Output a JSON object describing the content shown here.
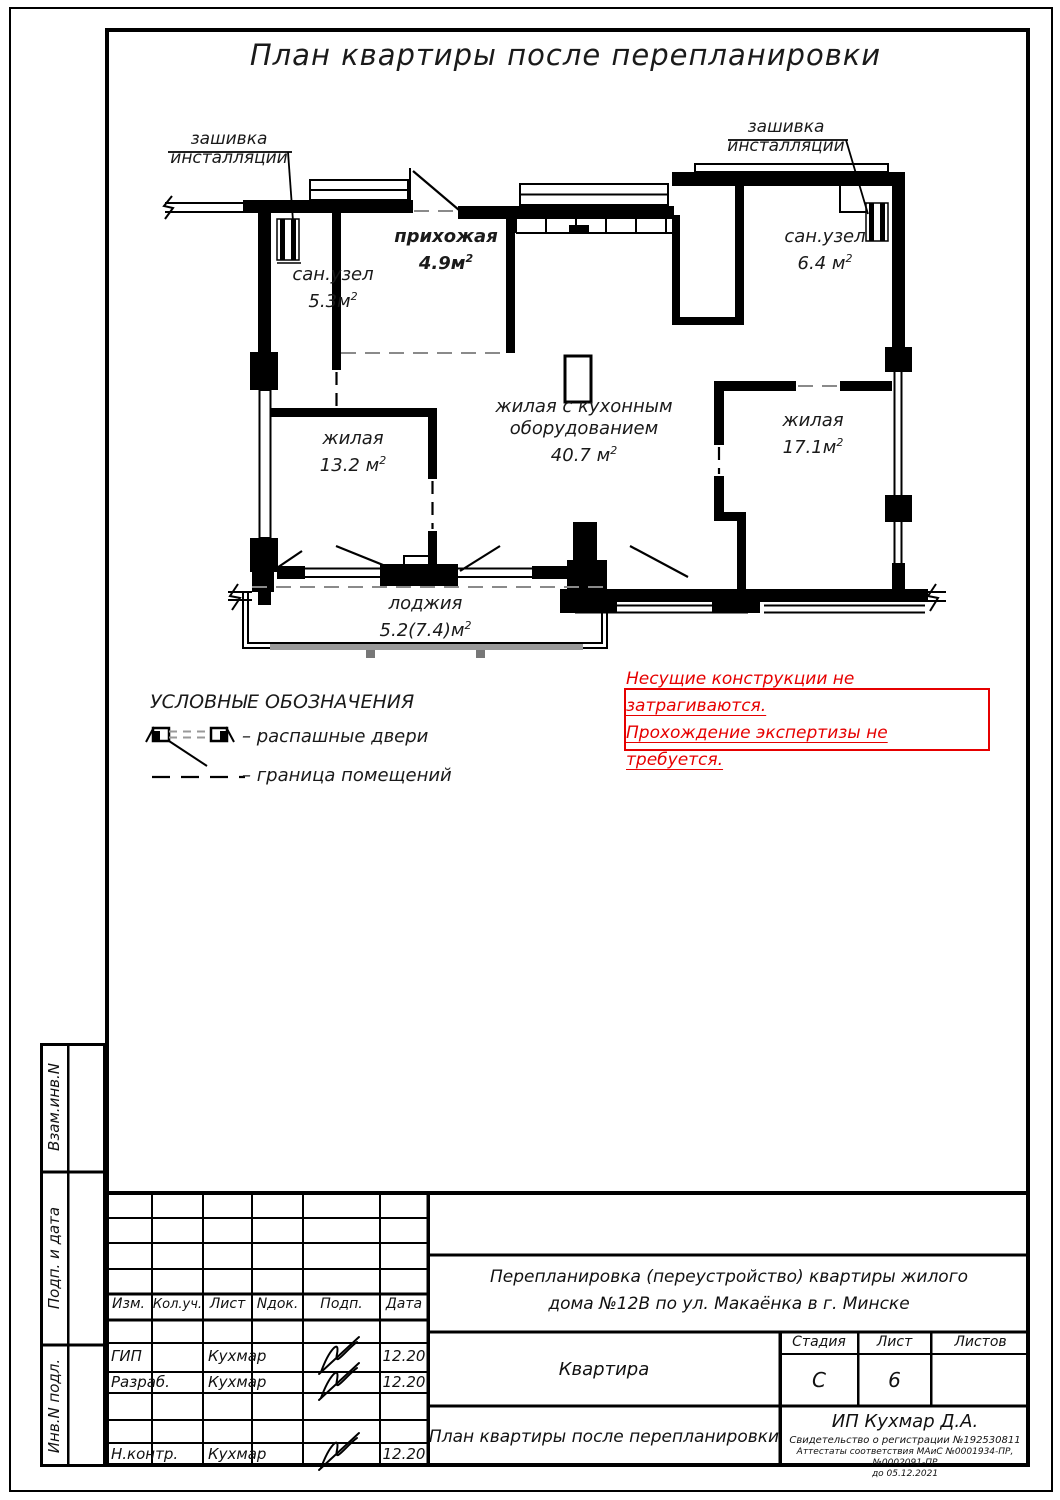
{
  "title": "План квартиры после перепланировки",
  "annotations": {
    "left": {
      "line1": "зашивка",
      "line2": "инсталляции"
    },
    "right": {
      "line1": "зашивка",
      "line2": "инсталляции"
    }
  },
  "rooms": {
    "san1": {
      "name": "сан.узел",
      "area": "5.3м",
      "sup": "2"
    },
    "hall": {
      "name": "прихожая",
      "area": "4.9м",
      "sup": "2"
    },
    "san2": {
      "name": "сан.узел",
      "area": "6.4 м",
      "sup": "2"
    },
    "living1": {
      "name": "жилая",
      "area": "13.2 м",
      "sup": "2"
    },
    "kitchen": {
      "name1": "жилая с кухонным",
      "name2": "оборудованием",
      "area": "40.7 м",
      "sup": "2"
    },
    "living2": {
      "name": "жилая",
      "area": "17.1м",
      "sup": "2"
    },
    "loggia": {
      "name": "лоджия",
      "area": "5.2(7.4)м",
      "sup": "2"
    }
  },
  "legend": {
    "title": "УСЛОВНЫЕ ОБОЗНАЧЕНИЯ",
    "door": "–  распашные двери",
    "boundary": "–  граница помещений"
  },
  "note": {
    "line1": "Несущие конструкции не затрагиваются.",
    "line2": "Прохождение экспертизы не требуется."
  },
  "sidebar": {
    "vzam": "Взам.инв.N",
    "podp": "Подп. и дата",
    "inv": "Инв.N подл."
  },
  "titleblock": {
    "headers": {
      "izm": "Изм.",
      "koluch": "Кол.уч.",
      "list": "Лист",
      "ndok": "Nдок.",
      "podp": "Подп.",
      "date": "Дата"
    },
    "rows": {
      "gip": {
        "role": "ГИП",
        "name": "Кухмар",
        "date": "12.20"
      },
      "razrab": {
        "role": "Разраб.",
        "name": "Кухмар",
        "date": "12.20"
      },
      "nkontr": {
        "role": "Н.контр.",
        "name": "Кухмар",
        "date": "12.20"
      }
    },
    "project": {
      "line1": "Перепланировка (переустройство) квартиры жилого",
      "line2": "дома №12В по ул. Макаёнка в г. Минске"
    },
    "object_name": "Квартира",
    "stage_label": "Стадия",
    "list_label": "Лист",
    "listov_label": "Листов",
    "stage": "С",
    "sheet": "6",
    "sheet_title": "План квартиры после перепланировки",
    "firm": {
      "name": "ИП Кухмар Д.А.",
      "cert": "Свидетельство о регистрации №192530811",
      "attest": "Аттестаты соответствия МАиС №0001934-ПР, №0002091-ПР",
      "until": "до 05.12.2021"
    }
  },
  "colors": {
    "accent_red": "#e60000"
  }
}
